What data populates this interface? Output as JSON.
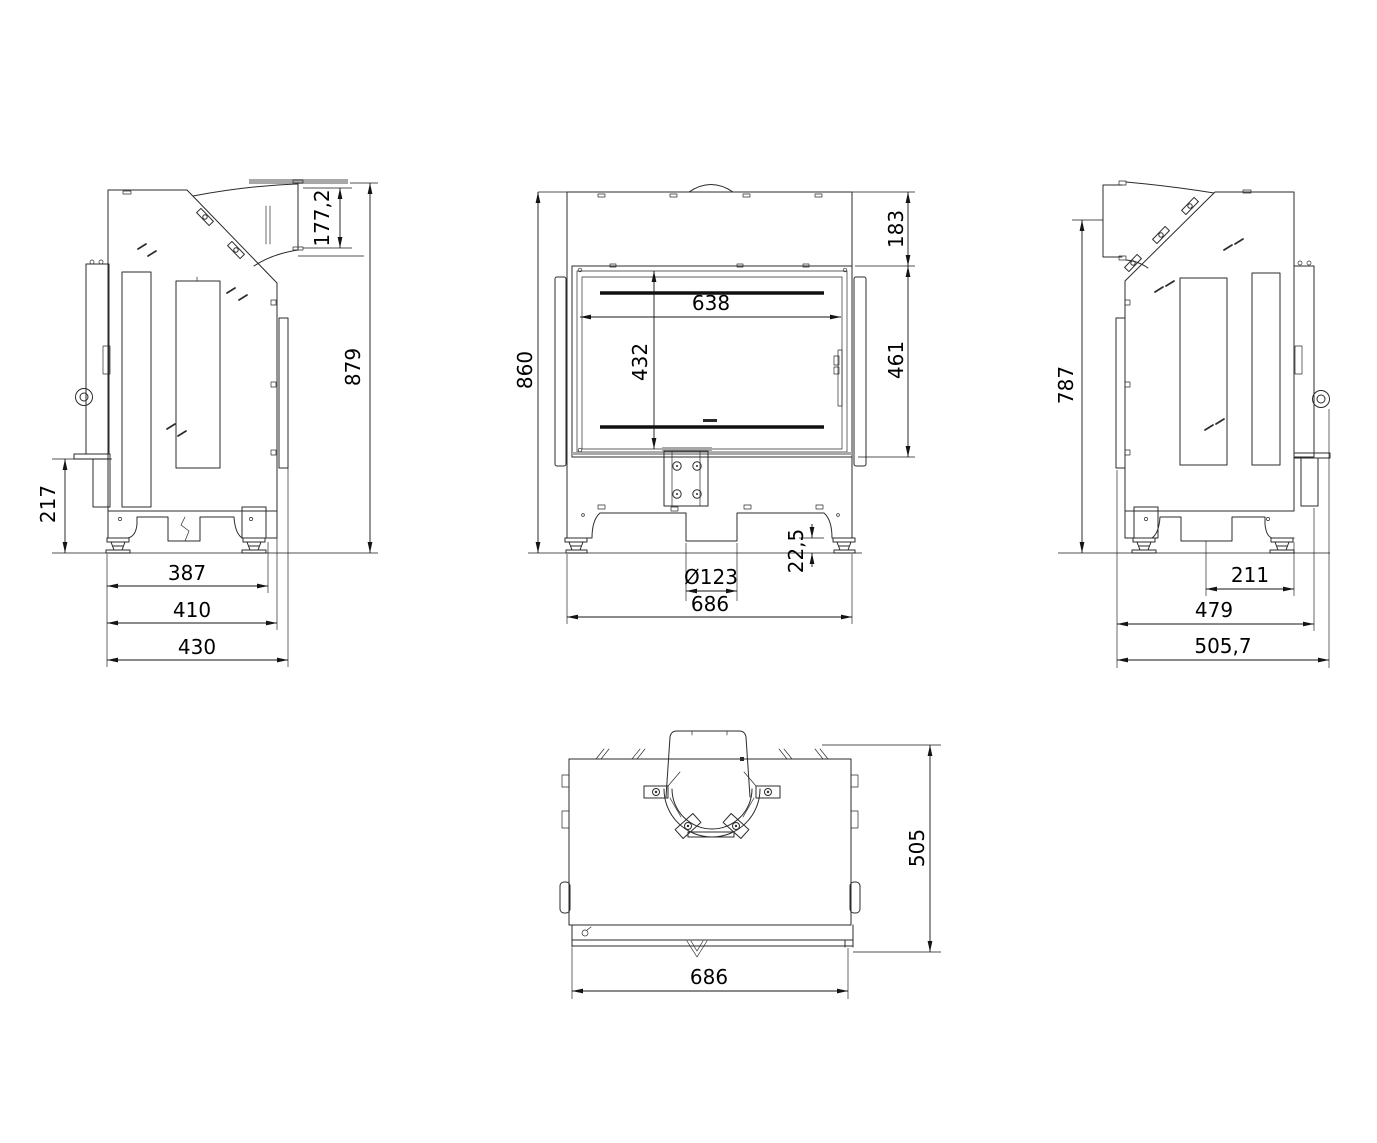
{
  "drawing": {
    "background_color": "#ffffff",
    "line_color": "#2b2b2b",
    "dimension_color": "#141414",
    "accent_gray": "#a8a8a8",
    "views": {
      "left_side": {
        "dims": {
          "flue_outlet": "177,2",
          "overall_height": "879",
          "plinth_height": "217",
          "feet_span": "387",
          "body_depth": "410",
          "overall_depth": "430"
        }
      },
      "front": {
        "dims": {
          "overall_height": "860",
          "top_section": "183",
          "glass_width": "638",
          "glass_height": "432",
          "door_height": "461",
          "air_inlet": "Ø123",
          "overall_width": "686",
          "foot_height": "22,5"
        }
      },
      "right_side": {
        "dims": {
          "rear_height": "787",
          "inlet_to_front": "211",
          "body_depth": "479",
          "overall_depth": "505,7"
        }
      },
      "top": {
        "dims": {
          "overall_depth": "505",
          "overall_width": "686"
        }
      }
    }
  }
}
